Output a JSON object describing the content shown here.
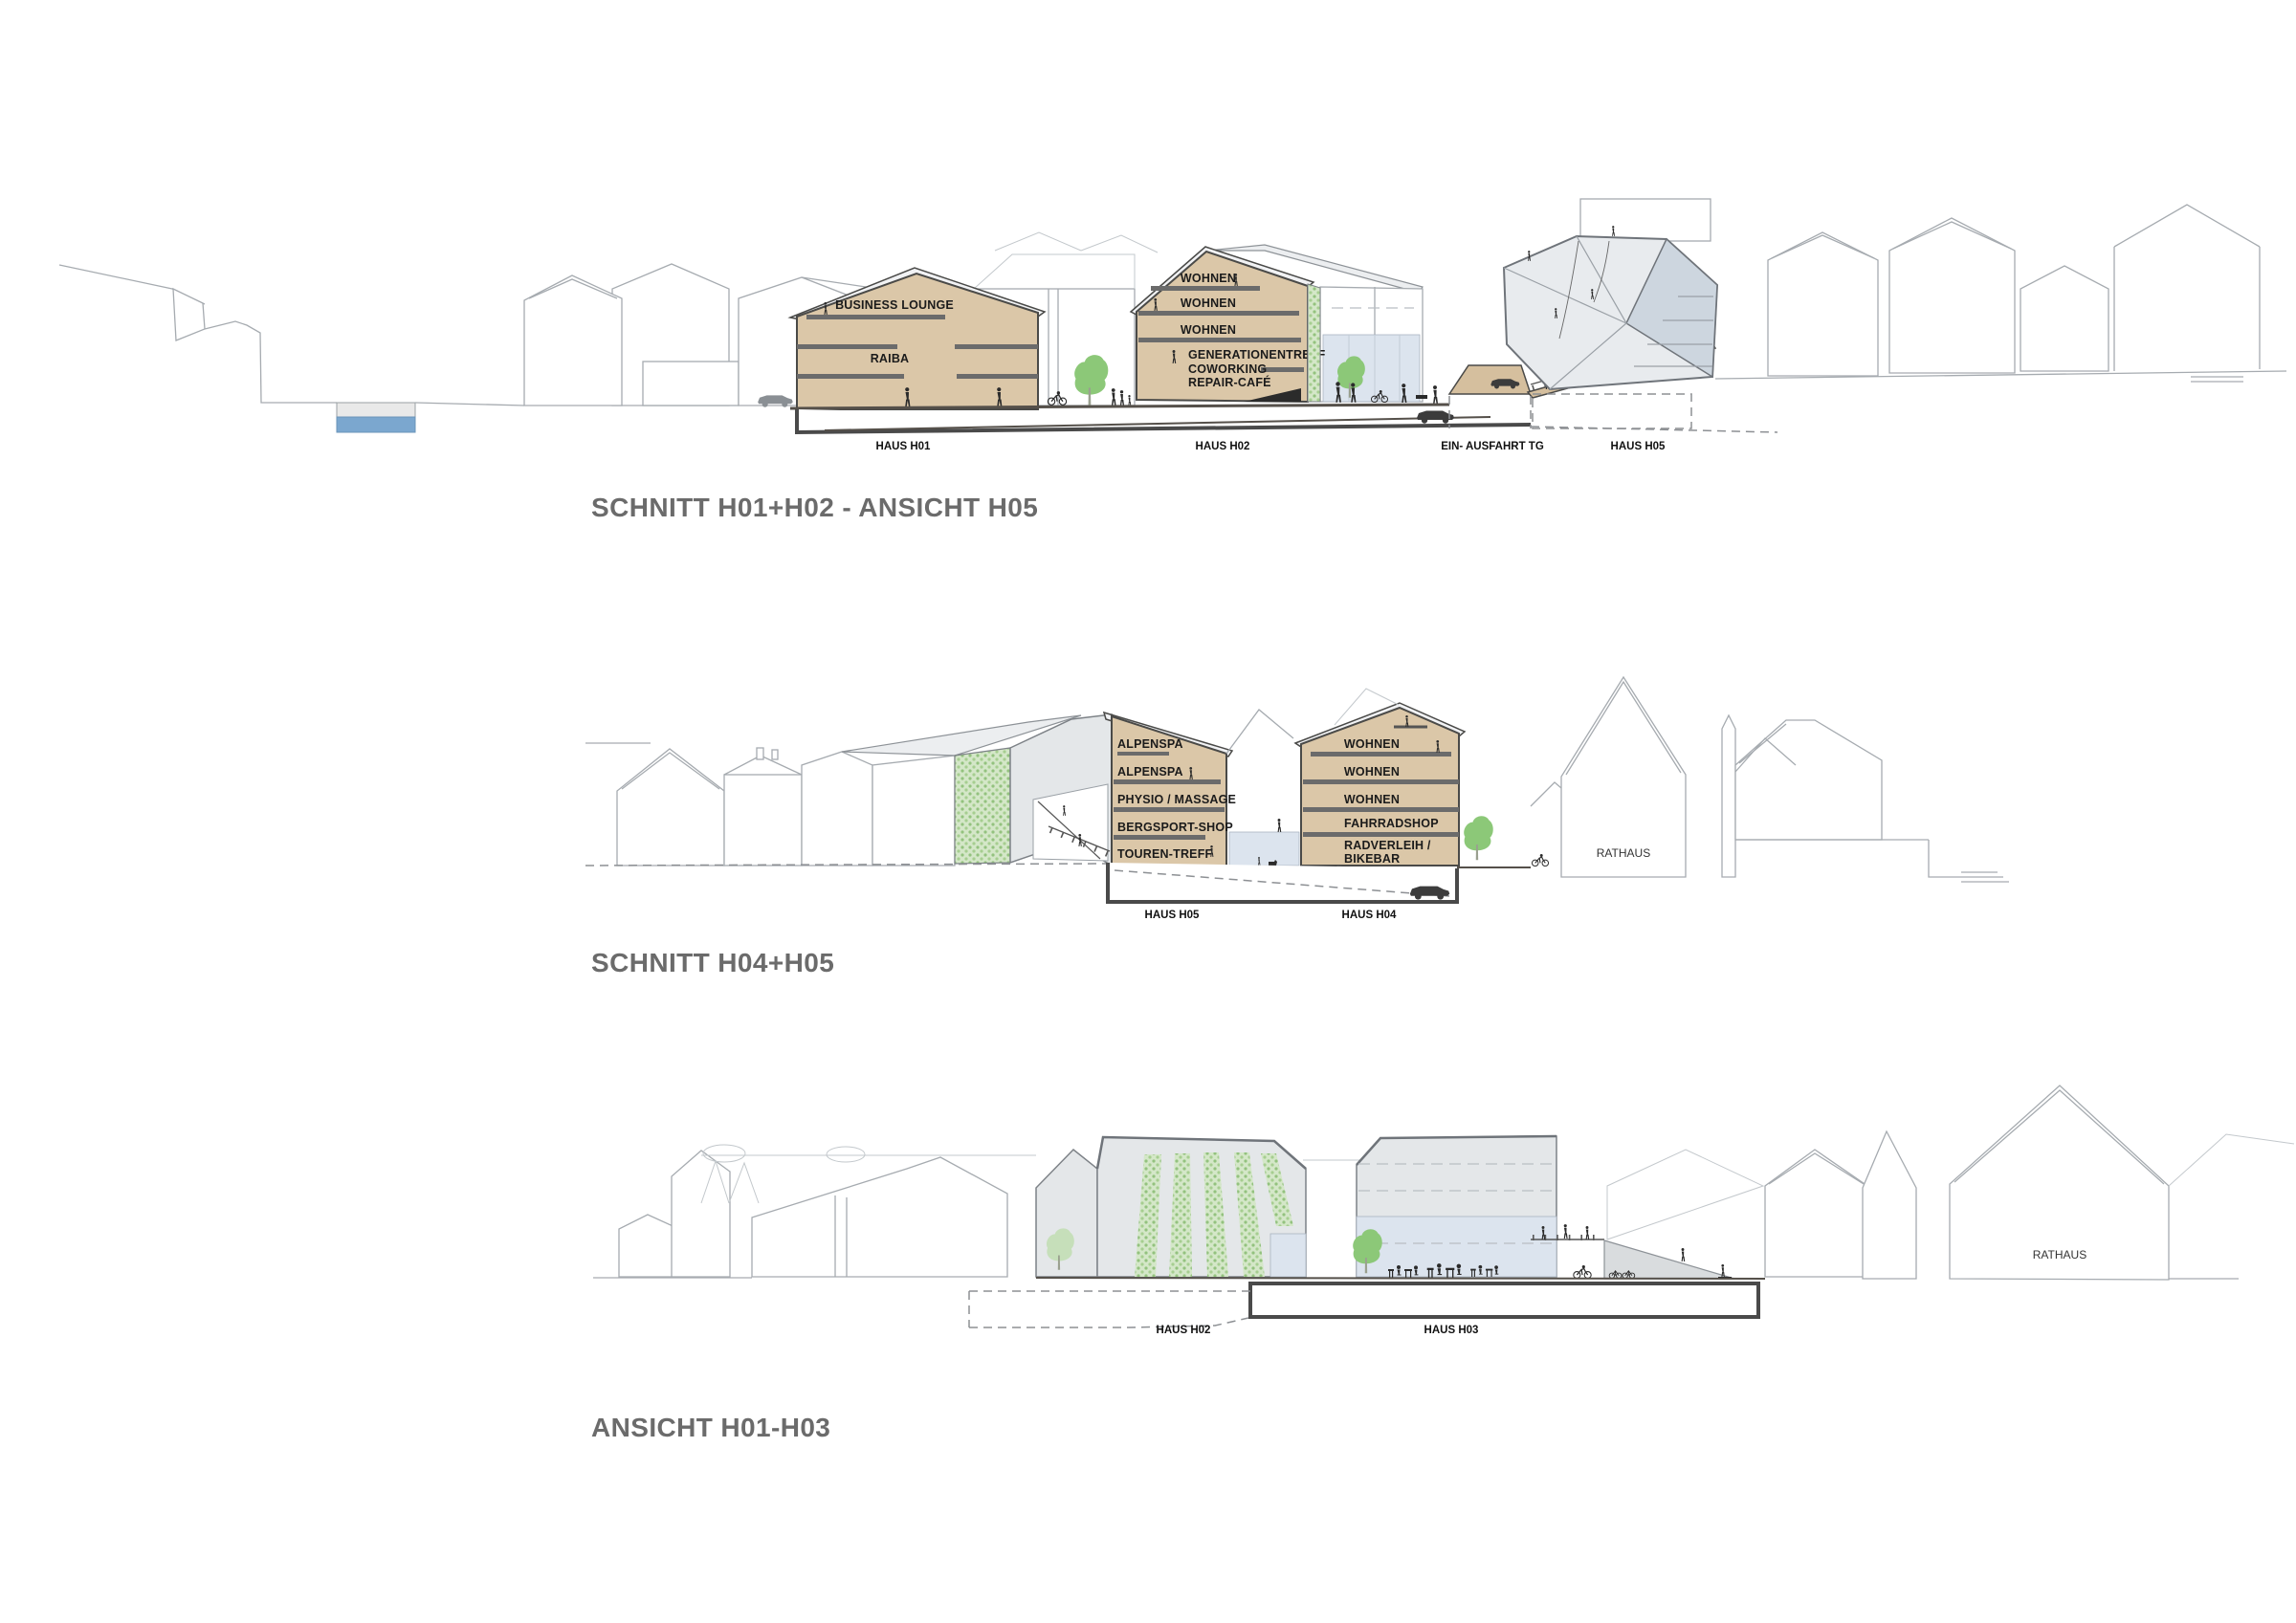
{
  "palette": {
    "section_fill": "#dbc7a8",
    "slab": "#6b6b6b",
    "roof": "#eceef0",
    "glass": "#dce4ee",
    "green_bright": "#8cc878",
    "green_pale": "#c6dfba",
    "water": "#7ba7cf",
    "outline": "#4a4a48",
    "context_outline": "#a6abb0",
    "title_color": "#6b6b6b"
  },
  "drawings": {
    "schnitt_h01_h02": {
      "title": "SCHNITT H01+H02 - ANSICHT H05",
      "rooms": {
        "business_lounge": "BUSINESS LOUNGE",
        "raiba": "RAIBA",
        "wohnen_1": "WOHNEN",
        "wohnen_2": "WOHNEN",
        "wohnen_3": "WOHNEN",
        "generationentreff": "GENERATIONENTREFF",
        "coworking": "COWORKING",
        "repair_cafe": "REPAIR-CAFÉ"
      },
      "ground_labels": {
        "h01": "HAUS H01",
        "h02": "HAUS H02",
        "tg": "EIN- AUSFAHRT TG",
        "h05": "HAUS H05"
      }
    },
    "schnitt_h04_h05": {
      "title": "SCHNITT H04+H05",
      "rooms": {
        "alpenspa_1": "ALPENSPA",
        "alpenspa_2": "ALPENSPA",
        "physio_massage": "PHYSIO / MASSAGE",
        "bergsport_shop": "BERGSPORT-SHOP",
        "touren_treff": "TOUREN-TREFF",
        "wohnen_1": "WOHNEN",
        "wohnen_2": "WOHNEN",
        "wohnen_3": "WOHNEN",
        "fahrradshop": "FAHRRADSHOP",
        "radverleih": "RADVERLEIH /",
        "bikebar": "BIKEBAR"
      },
      "context_labels": {
        "rathaus": "RATHAUS"
      },
      "ground_labels": {
        "h05": "HAUS H05",
        "h04": "HAUS H04"
      }
    },
    "ansicht_h01_h03": {
      "title": "ANSICHT H01-H03",
      "context_labels": {
        "rathaus": "RATHAUS"
      },
      "ground_labels": {
        "h02": "HAUS H02",
        "h03": "HAUS H03"
      }
    }
  }
}
